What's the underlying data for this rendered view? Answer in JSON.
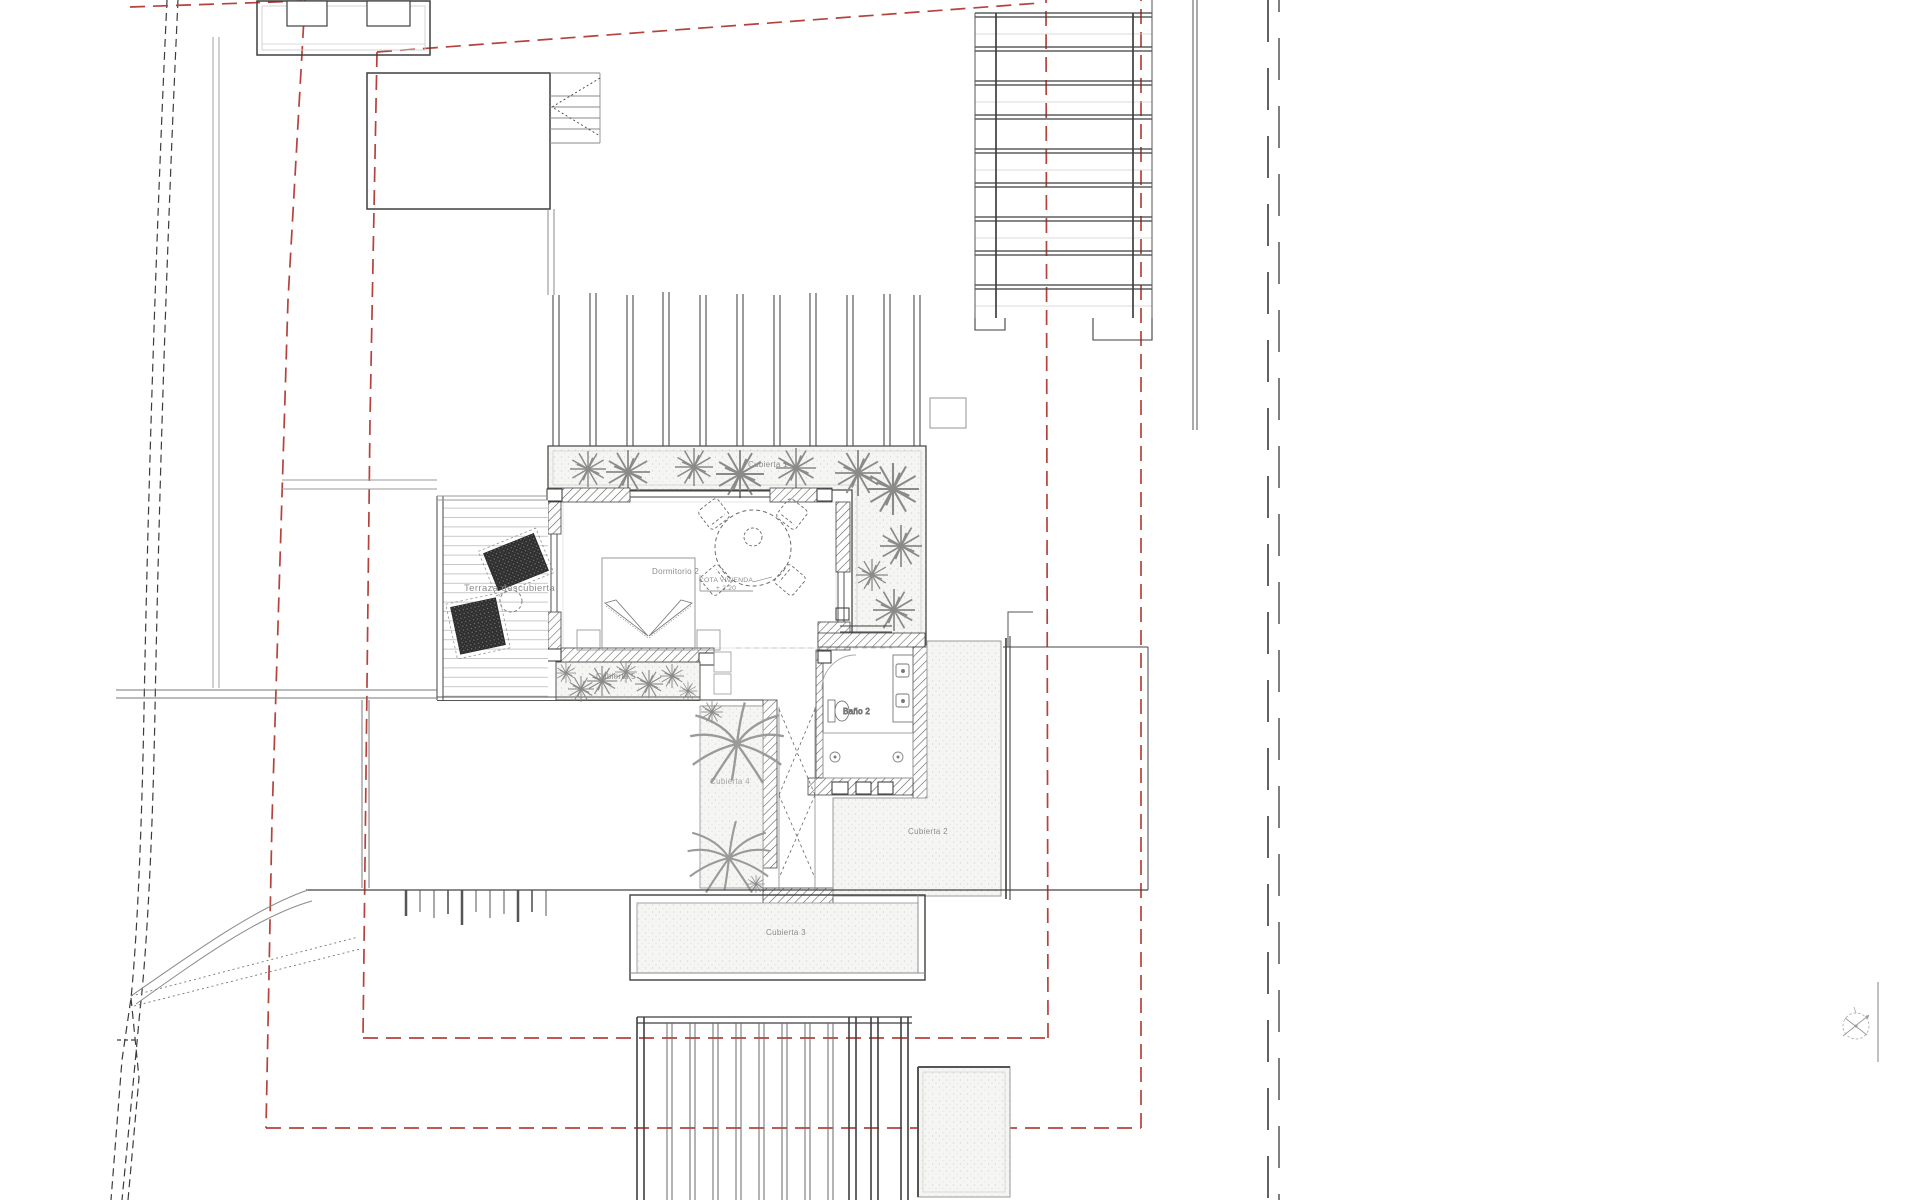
{
  "meta": {
    "drawing_type": "architectural site and roof plan",
    "view": "top view / planta de cubiertas"
  },
  "labels": {
    "cubierta1": "Cubierta 1",
    "terraza": "Terraza descubierta",
    "dormitorio": "Dormitorio 2",
    "cota_line1": "COTA VIVIENDA",
    "cota_line2": "+ 2.20",
    "cubierta5": "Cubierta 5",
    "cubierta4": "Cubierta 4",
    "bano": "Baño 2",
    "cubierta2": "Cubierta 2",
    "cubierta3": "Cubierta 3"
  },
  "colors": {
    "background": "#ffffff",
    "line_dark": "#3f3f3f",
    "line_medium": "#6e6e6e",
    "line_light": "#b5b5b5",
    "boundary_red": "#b5423c",
    "label_gray": "#8c8c8c",
    "stipple_fill": "#f4f4f2"
  },
  "legend": {
    "red_dashed": "plot boundary / setback lines",
    "black_dashed": "terrain contour lines",
    "hatched": "walls (section)",
    "stippled": "roof / gravel surfaces"
  }
}
